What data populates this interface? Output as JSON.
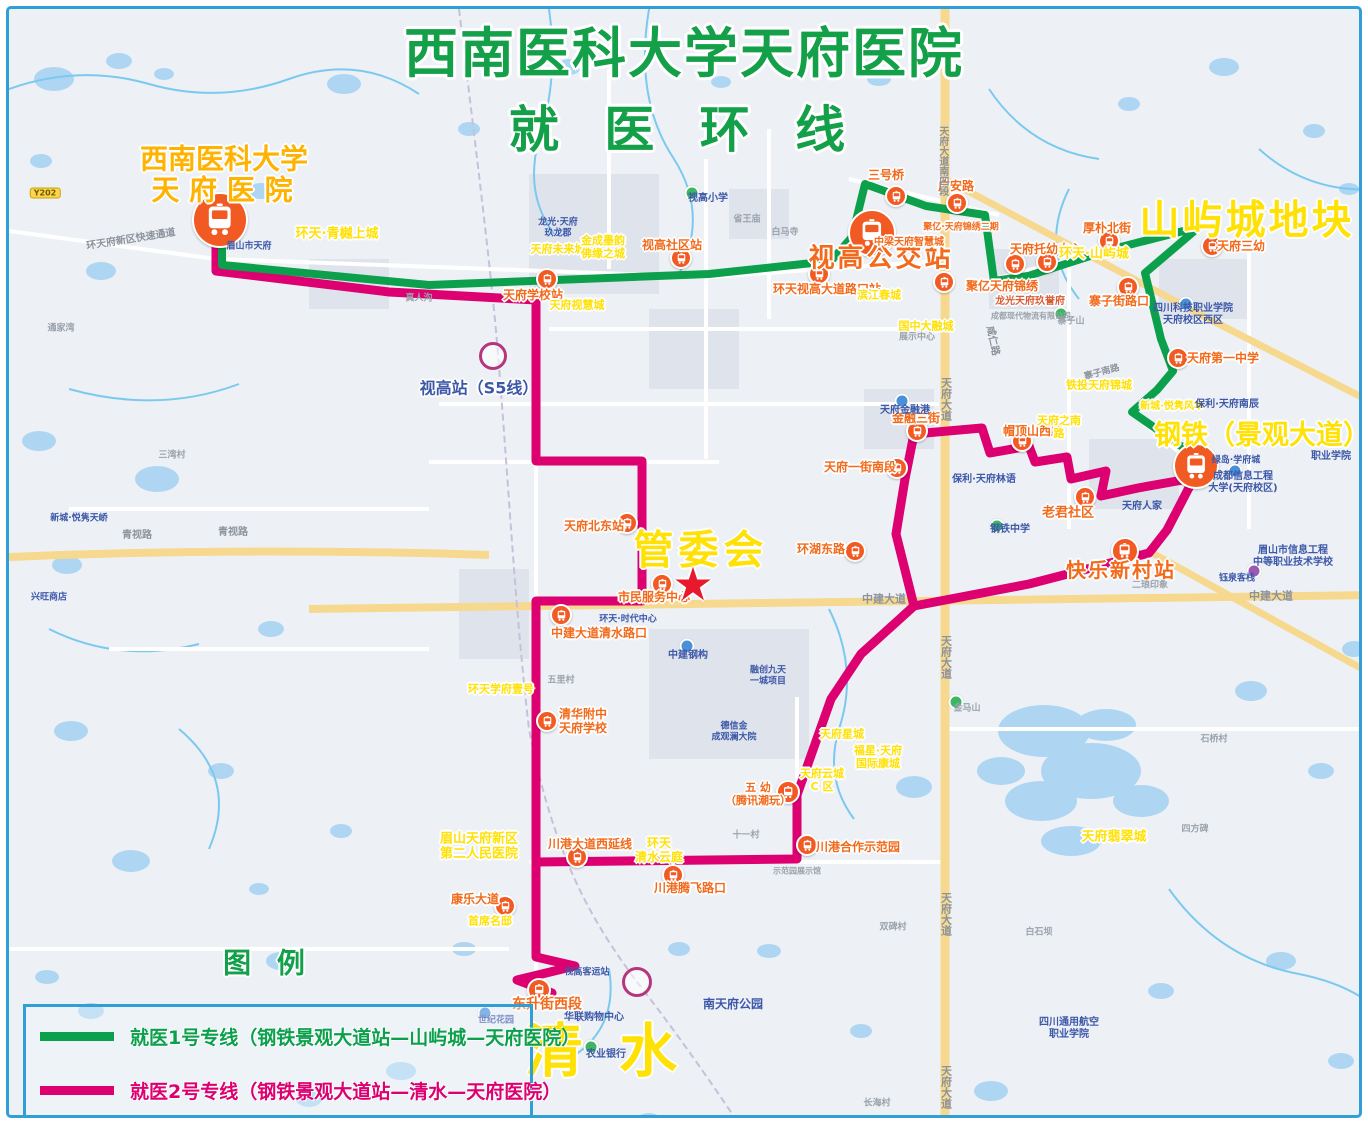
{
  "frame": {
    "border_color": "#2f9fd6"
  },
  "title": {
    "line1": "西南医科大学天府医院",
    "line2": "就 医 环 线",
    "color": "#13a049"
  },
  "legend": {
    "heading": "图 例",
    "items": [
      {
        "label": "就医1号专线（钢铁景观大道站—山屿城—天府医院）",
        "color": "#0ca04c"
      },
      {
        "label": "就医2号专线（钢铁景观大道站—清水—天府医院）",
        "color": "#dc0070"
      }
    ]
  },
  "routes": {
    "route1": {
      "name": "就医1号专线",
      "color": "#0ca04c",
      "width": 8,
      "points": "213,218 213,256 420,276 700,265 822,252 843,228 856,175 917,197 976,206 985,272 1019,267 1100,241 1190,218 1136,264 1152,330 1164,362 1148,381 1123,403 1185,446 1188,458"
    },
    "route2_main": {
      "name": "就医2号专线",
      "color": "#dc0070",
      "width": 9,
      "points": "207,224 207,262 380,283 527,291 527,452 633,452 633,592 527,592 527,948 566,957 508,971 543,984"
    },
    "route2_loop_west": {
      "name": "就医2号专线",
      "color": "#dc0070",
      "width": 9,
      "points": "905,425 896,470 887,525 905,597 852,645 822,690 788,786 788,850 527,853"
    },
    "route2_loop_east": {
      "name": "就医2号专线",
      "color": "#dc0070",
      "width": 9,
      "points": "905,425 973,419 981,444 1020,437 1026,453 1058,448 1062,470 1097,462 1092,487 1129,479 1185,469 1158,521 1140,544 1020,575 905,597"
    }
  },
  "stations": {
    "bus_icon_color": "#f15a22",
    "icons": [
      {
        "x": 211,
        "y": 211,
        "r": 26
      },
      {
        "x": 863,
        "y": 224,
        "r": 22
      },
      {
        "x": 1187,
        "y": 457,
        "r": 21
      },
      {
        "x": 1116,
        "y": 542,
        "r": 12
      },
      {
        "x": 530,
        "y": 981,
        "r": 10
      },
      {
        "x": 887,
        "y": 187,
        "r": 9
      },
      {
        "x": 948,
        "y": 194,
        "r": 9
      },
      {
        "x": 672,
        "y": 249,
        "r": 9
      },
      {
        "x": 810,
        "y": 265,
        "r": 9
      },
      {
        "x": 935,
        "y": 273,
        "r": 9
      },
      {
        "x": 1006,
        "y": 255,
        "r": 9
      },
      {
        "x": 1038,
        "y": 253,
        "r": 9
      },
      {
        "x": 1100,
        "y": 232,
        "r": 9
      },
      {
        "x": 1203,
        "y": 237,
        "r": 9
      },
      {
        "x": 1119,
        "y": 278,
        "r": 9
      },
      {
        "x": 1169,
        "y": 349,
        "r": 9
      },
      {
        "x": 888,
        "y": 459,
        "r": 9
      },
      {
        "x": 908,
        "y": 422,
        "r": 9
      },
      {
        "x": 1013,
        "y": 432,
        "r": 9
      },
      {
        "x": 1076,
        "y": 488,
        "r": 9
      },
      {
        "x": 846,
        "y": 542,
        "r": 9
      },
      {
        "x": 618,
        "y": 514,
        "r": 9
      },
      {
        "x": 653,
        "y": 575,
        "r": 9
      },
      {
        "x": 552,
        "y": 606,
        "r": 9
      },
      {
        "x": 538,
        "y": 712,
        "r": 9
      },
      {
        "x": 779,
        "y": 783,
        "r": 10
      },
      {
        "x": 568,
        "y": 848,
        "r": 9
      },
      {
        "x": 664,
        "y": 866,
        "r": 9
      },
      {
        "x": 798,
        "y": 836,
        "r": 9
      },
      {
        "x": 496,
        "y": 897,
        "r": 9
      },
      {
        "x": 538,
        "y": 270,
        "r": 9
      }
    ]
  },
  "labels": [
    {
      "t": "西南医科大学",
      "x": 215,
      "y": 150,
      "fs": 28,
      "cls": "oy ol"
    },
    {
      "t": "天 府 医 院",
      "x": 213,
      "y": 181,
      "fs": 28,
      "cls": "oy ol"
    },
    {
      "t": "山屿城地块",
      "x": 1238,
      "y": 212,
      "fs": 40,
      "cls": "yl ol",
      "ls": 3
    },
    {
      "t": "钢铁（景观大道）",
      "x": 1253,
      "y": 427,
      "fs": 27,
      "cls": "yl ol"
    },
    {
      "t": "管委会",
      "x": 692,
      "y": 542,
      "fs": 40,
      "cls": "yl ol",
      "ls": 5
    },
    {
      "t": "清 水",
      "x": 596,
      "y": 1042,
      "fs": 58,
      "cls": "yl ol",
      "ls": 8
    },
    {
      "t": "视高公交站",
      "x": 872,
      "y": 250,
      "fs": 26,
      "cls": "stop ol",
      "ls": 3
    },
    {
      "t": "快乐新村站",
      "x": 1112,
      "y": 562,
      "fs": 20,
      "cls": "stop ol",
      "ls": 2
    },
    {
      "t": "东升街西段",
      "x": 538,
      "y": 996,
      "fs": 14,
      "cls": "stop ol"
    },
    {
      "t": "图 例",
      "x": 259,
      "y": 954,
      "fs": 28,
      "cls": "green ol",
      "ls": 8
    },
    {
      "t": "三号桥",
      "x": 877,
      "y": 166,
      "fs": 12,
      "cls": "stop ol"
    },
    {
      "t": "广安路",
      "x": 947,
      "y": 177,
      "fs": 12,
      "cls": "stop ol"
    },
    {
      "t": "视高社区站",
      "x": 663,
      "y": 236,
      "fs": 12,
      "cls": "stop ol"
    },
    {
      "t": "环天视高大道路口站",
      "x": 818,
      "y": 280,
      "fs": 12,
      "cls": "stop ol"
    },
    {
      "t": "聚亿天府锦绣",
      "x": 993,
      "y": 277,
      "fs": 12,
      "cls": "stop ol"
    },
    {
      "t": "中梁天府智慧城",
      "x": 900,
      "y": 234,
      "fs": 10,
      "cls": "stop ol"
    },
    {
      "t": "聚亿·天府锦绣二期",
      "x": 952,
      "y": 219,
      "fs": 9,
      "cls": "stop ol"
    },
    {
      "t": "天府托幼中心",
      "x": 1037,
      "y": 240,
      "fs": 12,
      "cls": "stop ol"
    },
    {
      "t": "厚朴北街",
      "x": 1098,
      "y": 219,
      "fs": 12,
      "cls": "stop ol"
    },
    {
      "t": "天府三幼",
      "x": 1232,
      "y": 237,
      "fs": 12,
      "cls": "stop ol"
    },
    {
      "t": "寨子街路口",
      "x": 1110,
      "y": 292,
      "fs": 12,
      "cls": "stop ol"
    },
    {
      "t": "天府第一中学",
      "x": 1214,
      "y": 349,
      "fs": 12,
      "cls": "stop ol"
    },
    {
      "t": "天府一街南段",
      "x": 851,
      "y": 458,
      "fs": 12,
      "cls": "stop ol"
    },
    {
      "t": "金融三街",
      "x": 907,
      "y": 409,
      "fs": 12,
      "cls": "stop ol"
    },
    {
      "t": "帽顶山西路",
      "x": 1024,
      "y": 422,
      "fs": 12,
      "cls": "stop ol"
    },
    {
      "t": "老君社区",
      "x": 1059,
      "y": 504,
      "fs": 13,
      "cls": "stop ol"
    },
    {
      "t": "环湖东路",
      "x": 812,
      "y": 540,
      "fs": 12,
      "cls": "stop ol"
    },
    {
      "t": "天府北东站",
      "x": 585,
      "y": 517,
      "fs": 12,
      "cls": "stop ol"
    },
    {
      "t": "市民服务中心",
      "x": 645,
      "y": 588,
      "fs": 12,
      "cls": "stop ol"
    },
    {
      "t": "中建大道清水路口",
      "x": 590,
      "y": 624,
      "fs": 12,
      "cls": "stop ol"
    },
    {
      "t": "清华附中\n天府学校",
      "x": 574,
      "y": 712,
      "fs": 12,
      "cls": "stop ol"
    },
    {
      "t": "五 幼\n（腾讯潮玩）",
      "x": 749,
      "y": 786,
      "fs": 11,
      "cls": "stop ol"
    },
    {
      "t": "川港大道西延线",
      "x": 581,
      "y": 835,
      "fs": 12,
      "cls": "stop ol"
    },
    {
      "t": "川港腾飞路口",
      "x": 681,
      "y": 879,
      "fs": 12,
      "cls": "stop ol"
    },
    {
      "t": "川港合作示范园",
      "x": 849,
      "y": 838,
      "fs": 12,
      "cls": "stop ol"
    },
    {
      "t": "康乐大道",
      "x": 466,
      "y": 890,
      "fs": 12,
      "cls": "stop ol"
    },
    {
      "t": "天府学校站",
      "x": 524,
      "y": 286,
      "fs": 12,
      "cls": "stop ol"
    },
    {
      "t": "环天·青樾上城",
      "x": 328,
      "y": 225,
      "fs": 13,
      "cls": "yl ol"
    },
    {
      "t": "环天·山屿城",
      "x": 1085,
      "y": 245,
      "fs": 13,
      "cls": "yl ol"
    },
    {
      "t": "天府未来城",
      "x": 549,
      "y": 241,
      "fs": 11,
      "cls": "yl ol"
    },
    {
      "t": "金成墨韵\n佛缘之城",
      "x": 594,
      "y": 239,
      "fs": 11,
      "cls": "yl ol"
    },
    {
      "t": "天府视慧城",
      "x": 568,
      "y": 297,
      "fs": 11,
      "cls": "yl ol"
    },
    {
      "t": "滨江春城",
      "x": 870,
      "y": 287,
      "fs": 11,
      "cls": "yl ol"
    },
    {
      "t": "国中大融城",
      "x": 917,
      "y": 318,
      "fs": 11,
      "cls": "yl ol"
    },
    {
      "t": "展示中心",
      "x": 908,
      "y": 329,
      "fs": 9,
      "cls": "gy"
    },
    {
      "t": "铁投天府锦城",
      "x": 1090,
      "y": 377,
      "fs": 11,
      "cls": "yl ol"
    },
    {
      "t": "新城·悦隽风华",
      "x": 1163,
      "y": 398,
      "fs": 10,
      "cls": "yl ol"
    },
    {
      "t": "环天学府壹号",
      "x": 492,
      "y": 681,
      "fs": 11,
      "cls": "yl ol"
    },
    {
      "t": "眉山天府新区\n第二人民医院",
      "x": 470,
      "y": 838,
      "fs": 13,
      "cls": "yl ol"
    },
    {
      "t": "首席名邸",
      "x": 481,
      "y": 913,
      "fs": 11,
      "cls": "yl ol"
    },
    {
      "t": "环天\n清水云庭",
      "x": 650,
      "y": 841,
      "fs": 12,
      "cls": "yl ol"
    },
    {
      "t": "天府星城",
      "x": 833,
      "y": 726,
      "fs": 11,
      "cls": "yl ol"
    },
    {
      "t": "天府云城\nC 区",
      "x": 813,
      "y": 772,
      "fs": 11,
      "cls": "yl ol"
    },
    {
      "t": "福星·天府\n国际康城",
      "x": 869,
      "y": 749,
      "fs": 11,
      "cls": "yl ol"
    },
    {
      "t": "天府翡翠城",
      "x": 1105,
      "y": 828,
      "fs": 13,
      "cls": "yl ol"
    },
    {
      "t": "天府之南\n路",
      "x": 1050,
      "y": 419,
      "fs": 11,
      "cls": "yl ol"
    },
    {
      "t": "视高站（S5线）",
      "x": 470,
      "y": 380,
      "fs": 16,
      "cls": "nv ol"
    },
    {
      "t": "龙光·天府\n玖龙郡",
      "x": 549,
      "y": 219,
      "fs": 9,
      "cls": "nv"
    },
    {
      "t": "龙光天府玖誉府",
      "x": 1021,
      "y": 293,
      "fs": 10,
      "cls": "rust ol"
    },
    {
      "t": "成都现代物流有限公司",
      "x": 1022,
      "y": 307,
      "fs": 8,
      "cls": "gy"
    },
    {
      "t": "四川科技职业学院\n天府校区西区",
      "x": 1184,
      "y": 306,
      "fs": 10,
      "cls": "nv"
    },
    {
      "t": "成都信息工程\n大学(天府校区)",
      "x": 1234,
      "y": 474,
      "fs": 10,
      "cls": "nv"
    },
    {
      "t": "眉山市信息工程\n中等职业技术学校",
      "x": 1284,
      "y": 548,
      "fs": 10,
      "cls": "nv"
    },
    {
      "t": "职业学院",
      "x": 1322,
      "y": 448,
      "fs": 10,
      "cls": "nv"
    },
    {
      "t": "绿岛·学府城",
      "x": 1227,
      "y": 452,
      "fs": 9,
      "cls": "nv"
    },
    {
      "t": "天府人家",
      "x": 1133,
      "y": 498,
      "fs": 10,
      "cls": "nv"
    },
    {
      "t": "天府金融港",
      "x": 896,
      "y": 402,
      "fs": 10,
      "cls": "nv"
    },
    {
      "t": "保利·天府林语",
      "x": 975,
      "y": 471,
      "fs": 10,
      "cls": "nv"
    },
    {
      "t": "保利·天府南辰",
      "x": 1218,
      "y": 396,
      "fs": 10,
      "cls": "nv"
    },
    {
      "t": "钢铁中学",
      "x": 1001,
      "y": 521,
      "fs": 10,
      "cls": "nv"
    },
    {
      "t": "华联购物中心",
      "x": 585,
      "y": 1009,
      "fs": 10,
      "cls": "nv"
    },
    {
      "t": "农业银行",
      "x": 597,
      "y": 1046,
      "fs": 10,
      "cls": "nv"
    },
    {
      "t": "南天府公园",
      "x": 724,
      "y": 995,
      "fs": 12,
      "cls": "nv"
    },
    {
      "t": "四川通用航空\n职业学院",
      "x": 1060,
      "y": 1020,
      "fs": 10,
      "cls": "nv"
    },
    {
      "t": "新城·悦隽天峤",
      "x": 70,
      "y": 510,
      "fs": 9,
      "cls": "nv"
    },
    {
      "t": "兴旺商店",
      "x": 40,
      "y": 589,
      "fs": 9,
      "cls": "nv"
    },
    {
      "t": "视高小学",
      "x": 699,
      "y": 190,
      "fs": 10,
      "cls": "nv"
    },
    {
      "t": "视高客运站",
      "x": 578,
      "y": 964,
      "fs": 9,
      "cls": "nv"
    },
    {
      "t": "世纪花园",
      "x": 487,
      "y": 1012,
      "fs": 9,
      "cls": "nv"
    },
    {
      "t": "中建钢构",
      "x": 679,
      "y": 647,
      "fs": 10,
      "cls": "nv"
    },
    {
      "t": "融创九天\n一城项目",
      "x": 759,
      "y": 667,
      "fs": 9,
      "cls": "nv"
    },
    {
      "t": "德信金\n成观澜大院",
      "x": 725,
      "y": 723,
      "fs": 9,
      "cls": "nv"
    },
    {
      "t": "环天·时代中心",
      "x": 619,
      "y": 611,
      "fs": 9,
      "cls": "nv"
    },
    {
      "t": "二琅印象",
      "x": 1141,
      "y": 577,
      "fs": 9,
      "cls": "gy"
    },
    {
      "t": "钰泉客栈",
      "x": 1228,
      "y": 570,
      "fs": 9,
      "cls": "nv"
    },
    {
      "t": "眉山市天府",
      "x": 240,
      "y": 238,
      "fs": 9,
      "cls": "nv"
    },
    {
      "t": "真人沟",
      "x": 410,
      "y": 290,
      "fs": 9,
      "cls": "gy"
    },
    {
      "t": "三湾村",
      "x": 163,
      "y": 447,
      "fs": 9,
      "cls": "gy"
    },
    {
      "t": "五里村",
      "x": 552,
      "y": 672,
      "fs": 9,
      "cls": "gy"
    },
    {
      "t": "白马寺",
      "x": 776,
      "y": 224,
      "fs": 9,
      "cls": "gy"
    },
    {
      "t": "省王庙",
      "x": 738,
      "y": 211,
      "fs": 9,
      "cls": "gy"
    },
    {
      "t": "十一村",
      "x": 737,
      "y": 827,
      "fs": 9,
      "cls": "gy"
    },
    {
      "t": "双碑村",
      "x": 884,
      "y": 919,
      "fs": 9,
      "cls": "gy"
    },
    {
      "t": "白石坝",
      "x": 1030,
      "y": 924,
      "fs": 9,
      "cls": "gy"
    },
    {
      "t": "长海村",
      "x": 868,
      "y": 1095,
      "fs": 9,
      "cls": "gy"
    },
    {
      "t": "石桥村",
      "x": 1205,
      "y": 731,
      "fs": 9,
      "cls": "gy"
    },
    {
      "t": "四方碑",
      "x": 1186,
      "y": 821,
      "fs": 9,
      "cls": "gy"
    },
    {
      "t": "通家湾",
      "x": 52,
      "y": 320,
      "fs": 9,
      "cls": "gy"
    },
    {
      "t": "金马山",
      "x": 958,
      "y": 700,
      "fs": 9,
      "cls": "gy"
    },
    {
      "t": "寨子山",
      "x": 1062,
      "y": 313,
      "fs": 9,
      "cls": "gy"
    },
    {
      "t": "示范园展示馆",
      "x": 788,
      "y": 862,
      "fs": 8,
      "cls": "gy"
    },
    {
      "t": "环天府新区快速通道",
      "x": 122,
      "y": 231,
      "fs": 10,
      "cls": "rd",
      "rot": -9
    },
    {
      "t": "青视路",
      "x": 128,
      "y": 527,
      "fs": 10,
      "cls": "rd"
    },
    {
      "t": "青视路",
      "x": 224,
      "y": 524,
      "fs": 10,
      "cls": "rd"
    },
    {
      "t": "咸仁路",
      "x": 983,
      "y": 332,
      "fs": 10,
      "cls": "rd",
      "rot": 78
    },
    {
      "t": "寨子南路",
      "x": 1093,
      "y": 364,
      "fs": 9,
      "cls": "rd",
      "rot": -15
    },
    {
      "t": "中建大道",
      "x": 875,
      "y": 591,
      "fs": 11,
      "cls": "rd"
    },
    {
      "t": "中建大道",
      "x": 1262,
      "y": 588,
      "fs": 11,
      "cls": "rd"
    },
    {
      "t": "天府大道",
      "x": 936,
      "y": 390,
      "fs": 11,
      "cls": "rd",
      "vert": true
    },
    {
      "t": "天府大道",
      "x": 936,
      "y": 648,
      "fs": 11,
      "cls": "rd",
      "vert": true
    },
    {
      "t": "天府大道",
      "x": 936,
      "y": 905,
      "fs": 11,
      "cls": "rd",
      "vert": true
    },
    {
      "t": "天府大道",
      "x": 936,
      "y": 1078,
      "fs": 11,
      "cls": "rd",
      "vert": true
    },
    {
      "t": "天府大道南四段",
      "x": 933,
      "y": 152,
      "fs": 10,
      "cls": "rd",
      "vert": true
    }
  ],
  "poi_dots": [
    {
      "x": 683,
      "y": 184,
      "color": "#3db563"
    },
    {
      "x": 988,
      "y": 517,
      "color": "#3db563"
    },
    {
      "x": 947,
      "y": 693,
      "color": "#3db563"
    },
    {
      "x": 1052,
      "y": 305,
      "color": "#3db563"
    },
    {
      "x": 582,
      "y": 1038,
      "color": "#3db563"
    },
    {
      "x": 893,
      "y": 392,
      "color": "#4a90d9"
    },
    {
      "x": 678,
      "y": 637,
      "color": "#4a90d9"
    },
    {
      "x": 476,
      "y": 1004,
      "color": "#4a90d9"
    },
    {
      "x": 1177,
      "y": 295,
      "color": "#4a90d9"
    },
    {
      "x": 1226,
      "y": 462,
      "color": "#4a90d9"
    },
    {
      "x": 1245,
      "y": 562,
      "color": "#9b59b6"
    }
  ],
  "rings": [
    {
      "x": 484,
      "y": 347,
      "r": 11
    },
    {
      "x": 628,
      "y": 973,
      "r": 12
    }
  ],
  "star": {
    "glyph": "★",
    "x": 684,
    "y": 575,
    "size": 46,
    "color": "#e8192c"
  },
  "badge": {
    "text": "Y202",
    "x": 36,
    "y": 184
  }
}
